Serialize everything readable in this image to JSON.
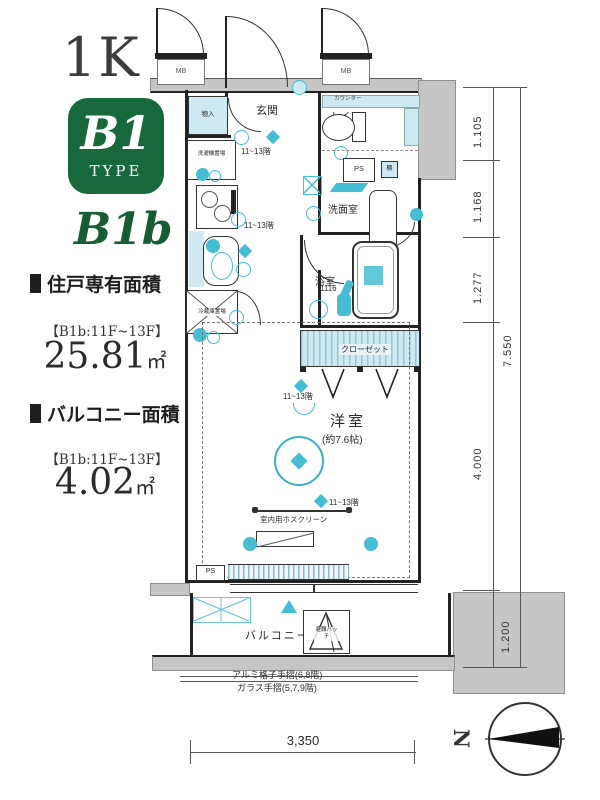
{
  "info_panel": {
    "layout_type": "1K",
    "type_badge": {
      "code": "B1",
      "word": "TYPE"
    },
    "subtype": "B1b",
    "unit_area": {
      "heading": "住戸専有面積",
      "floors": "【B1b:11F~13F】",
      "value": "25.81",
      "unit": "㎡"
    },
    "balcony_area": {
      "heading": "バルコニー面積",
      "floors": "【B1b:11F~13F】",
      "value": "4.02",
      "unit": "㎡"
    }
  },
  "plan": {
    "room_labels": {
      "genkan": "玄関",
      "toilet": "トイレ",
      "washroom": "洗面室",
      "bathroom": "浴室",
      "bathroom_size": "1116",
      "closet": "クローゼット",
      "western_room": "洋室",
      "western_room_size": "(約7.6帖)",
      "balcony": "バルコニー"
    },
    "fixture_labels": {
      "mb": "MB",
      "ps": "PS",
      "shelf": "棚",
      "counter": "カウンター",
      "storage": "物入",
      "washer": "洗濯機置場",
      "fridge": "冷蔵庫置場",
      "hatch": "避難ハッチ",
      "hoscreen": "室内用ホスクリーン",
      "floor_range": "11~13階"
    },
    "notes": {
      "railing_note1": "アルミ格子手摺(6,8階)",
      "railing_note2": "ガラス手摺(5,7,9階)"
    },
    "dimensions": {
      "v1": "1.105",
      "v2": "1.168",
      "v3": "1.277",
      "v4": "4.000",
      "v5": "1.200",
      "v_total": "7.550",
      "h_total": "3,350"
    },
    "compass": {
      "north": "N"
    }
  },
  "colors": {
    "accent_green": "#17683b",
    "symbol_teal": "#45bdd5",
    "fill_lightblue": "#cde9f4",
    "wall_gray": "#c6c6c6"
  }
}
